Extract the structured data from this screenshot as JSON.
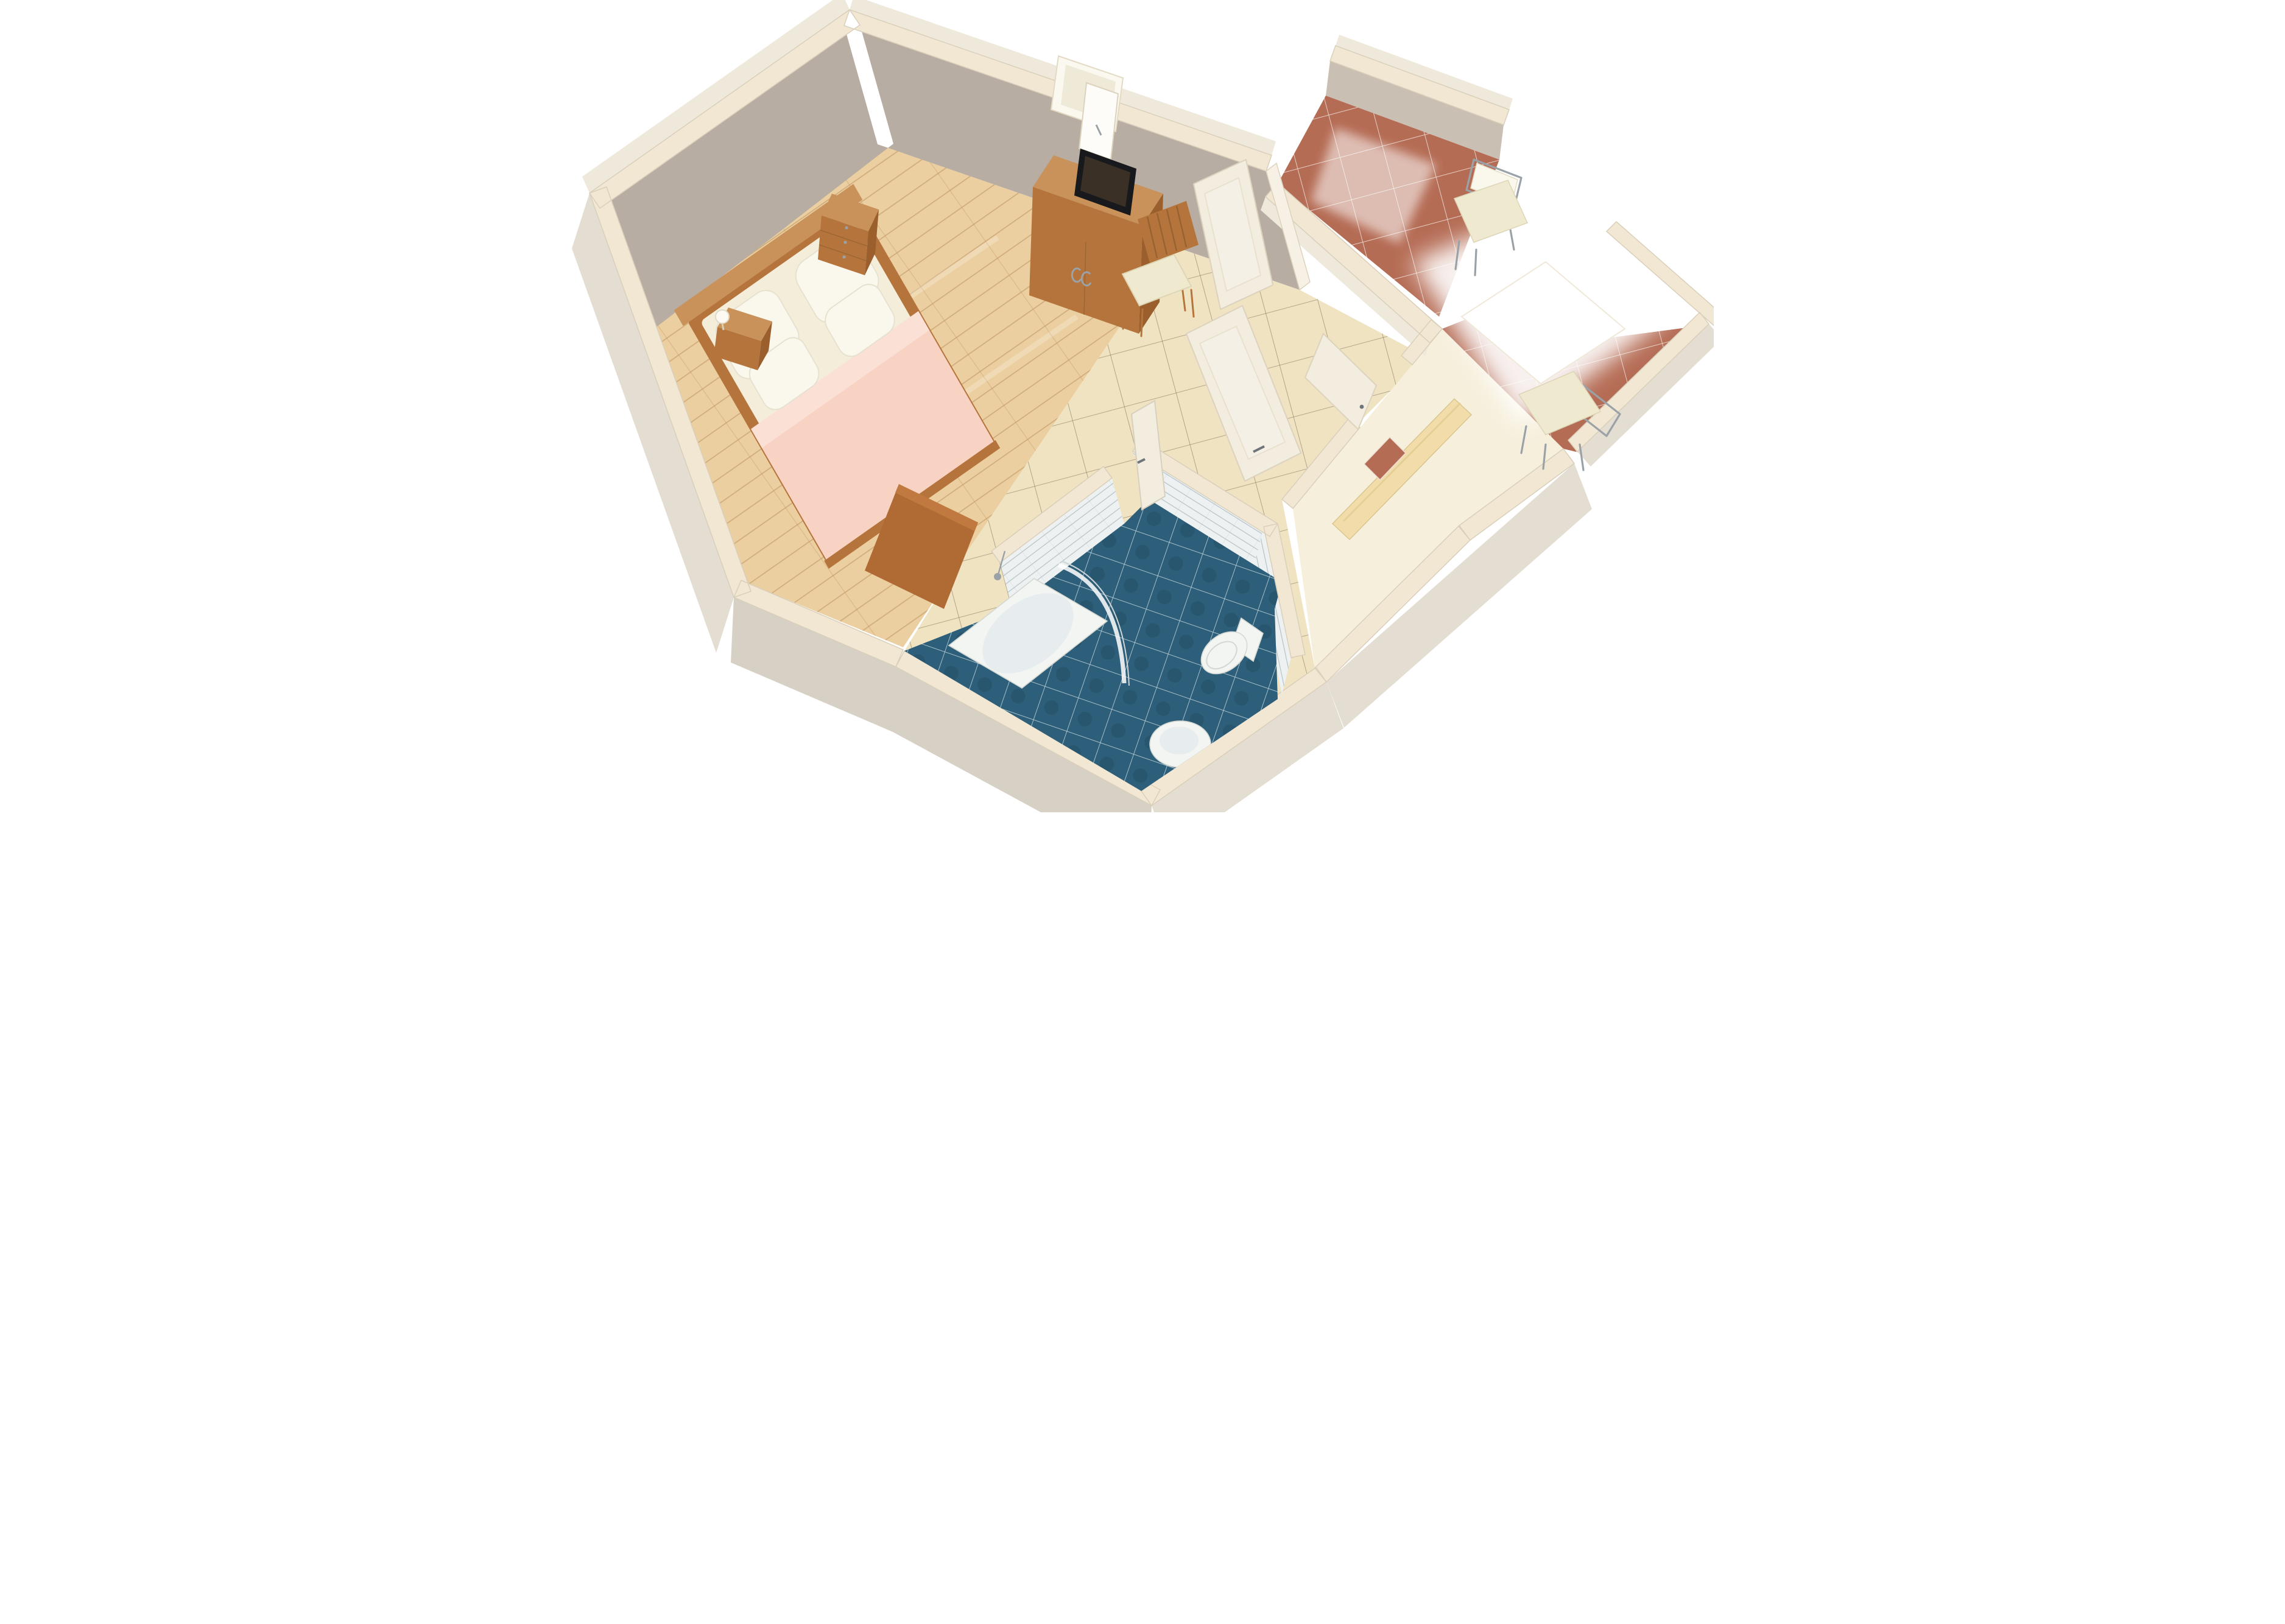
{
  "scene": {
    "kind": "3d-floorplan-render",
    "view": "axonometric cutaway from above",
    "visible_text": "none",
    "rooms": [
      {
        "name": "bedroom",
        "floor": "light wood planks",
        "objects": [
          "double-bed",
          "pink-blanket",
          "four-white-pillows",
          "wood-headboard",
          "bedside-table-with-lamp",
          "three-drawer-nightstand",
          "tv-cabinet",
          "flat-screen-tv",
          "window-open-casement",
          "wood-chair-cream-seat",
          "low-wood-chest"
        ]
      },
      {
        "name": "entry-hall",
        "floor": "beige ceramic tiles laid diagonally",
        "objects": [
          "french-glass-door-leaf-upper",
          "french-glass-door-leaf-lower",
          "bathroom-door-open",
          "entrance-door-open",
          "built-in-wardrobe",
          "door-mat"
        ]
      },
      {
        "name": "bathroom",
        "floor": "dark blue tiles",
        "walls": "white tiles",
        "objects": [
          "corner-bathtub",
          "curved-glass-shower-screen",
          "shower-mixer",
          "toilet",
          "wash-basin"
        ]
      },
      {
        "name": "balcony",
        "floor": "glossy terracotta tiles",
        "objects": [
          "metal-chair-upper",
          "metal-chair-lower",
          "white-table",
          "wall-stub"
        ]
      }
    ]
  },
  "colors": {
    "background": "#ffffff",
    "wall_top": "#f1e7d3",
    "wall_outer_light": "#efe9dc",
    "wall_outer": "#e4ddd1",
    "wall_outer_shadow": "#d7d0c5",
    "wall_inner_taupe": "#b8ada2",
    "wall_inner_light": "#c9bfb2",
    "wood_floor": "#eccfa0",
    "wood_plank_line": "#c39a66",
    "tile_beige": "#f0e3c1",
    "tile_grout_dark": "#75684f",
    "terracotta": "#b56c55",
    "terracotta_grout": "#ecdfd6",
    "corridor_pale": "#f6efdc",
    "bath_blue": "#2e5f7a",
    "bath_grout": "#c2d6de",
    "bath_wall_tile": "#edf1f2",
    "bath_wall_grout": "#b7c3c7",
    "furniture_wood": "#b5743c",
    "furniture_wood_light": "#c8925a",
    "furniture_wood_dark": "#9a5f2d",
    "desk_wood": "#b06a34",
    "birch": "#f2ddaa",
    "bed_sheet": "#f4edda",
    "pillow": "#faf7ec",
    "blanket_pink": "#f8d2c3",
    "blanket_fold": "#fbe0d5",
    "door_white": "#f3ede0",
    "metal": "#9aa2a8",
    "cushion_cream": "#efe9cf",
    "tv_black": "#17191c",
    "fixture_white": "#f3f5f2",
    "table_white": "#ffffff"
  }
}
